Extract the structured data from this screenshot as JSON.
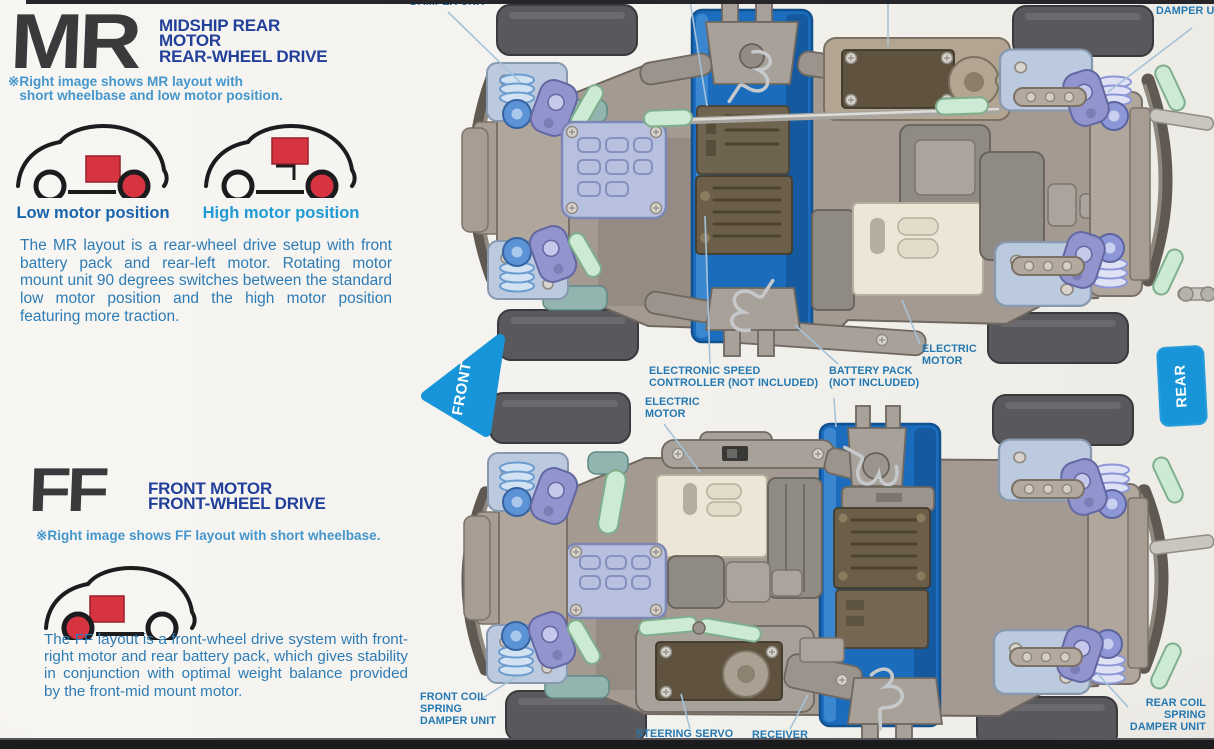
{
  "mr_section": {
    "logo": "MR",
    "heading": "MIDSHIP REAR\nMOTOR\nREAR-WHEEL DRIVE",
    "note": "※Right image shows MR layout with\n   short wheelbase and low motor position.",
    "low_motor_label": "Low motor position",
    "high_motor_label": "High motor position",
    "body": "The MR layout is a rear-wheel drive setup with front battery pack and rear-left motor. Rotating motor mount unit 90 degrees switches between the standard low motor position and the high motor position featuring more traction."
  },
  "ff_section": {
    "logo": "FF",
    "heading": "FRONT MOTOR\nFRONT-WHEEL DRIVE",
    "note": "※Right image shows FF layout with short wheelbase.",
    "body": "The FF layout is a front-wheel drive system with front-right motor and rear battery pack, which gives stability in conjunction with optimal weight balance provided by the front-mid mount motor."
  },
  "diagram": {
    "front_marker": "FRONT",
    "rear_marker": "REAR",
    "labels": {
      "damper_unit_top_left": "DAMPER UNIT",
      "damper_unit_top_right": "DAMPER UNIT",
      "esc": "ELECTRONIC SPEED\nCONTROLLER (NOT INCLUDED)",
      "battery_pack": "BATTERY PACK\n(NOT INCLUDED)",
      "electric_motor_mr": "ELECTRIC\nMOTOR",
      "electric_motor_ff": "ELECTRIC\nMOTOR",
      "front_coil": "FRONT COIL\nSPRING\nDAMPER UNIT",
      "rear_coil": "REAR COIL\nSPRING\nDAMPER UNIT",
      "steering_servo": "STEERING SERVO\n(NOT INCLUDED)",
      "receiver": "RECEIVER\n(NOT INCLUDED)"
    }
  },
  "colors": {
    "heading_navy": "#21409a",
    "note_blue": "#4496cc",
    "body_blue": "#2d7cb5",
    "label_blue": "#2579b2",
    "motor_red": "#d63440",
    "chassis_tub_blue": "#1b6cbd",
    "marker_blue": "#1795d8",
    "logo_charcoal": "#3a393c",
    "paper": "#f4f2ee"
  }
}
